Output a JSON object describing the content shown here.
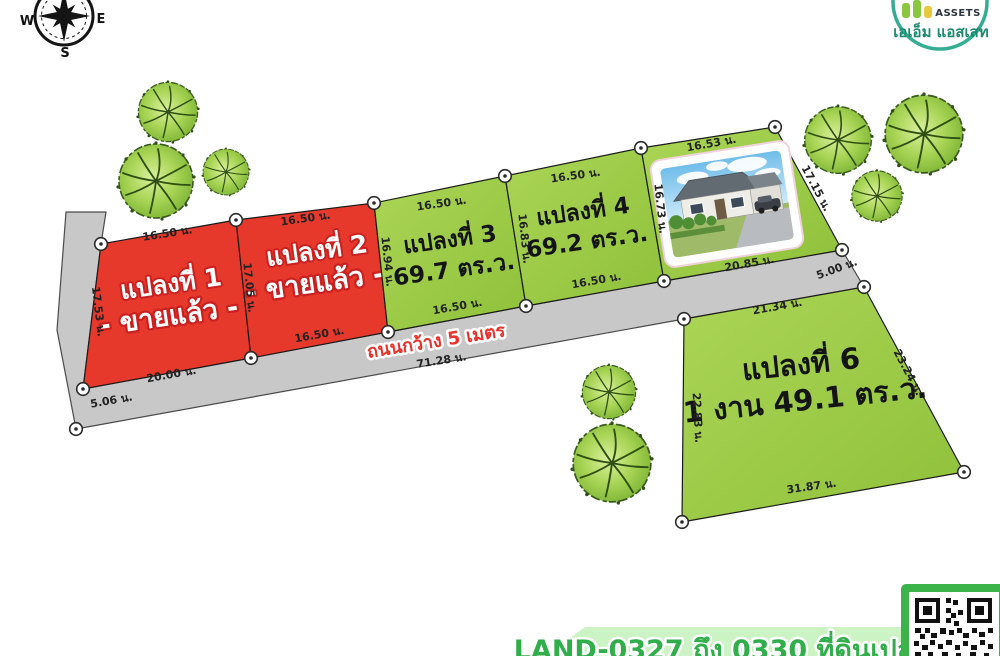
{
  "compass": {
    "west": "W",
    "east": "E",
    "south": "S"
  },
  "logo": {
    "name_en": "ASSETS",
    "name_th": "เอเอ็ม แอสเสท"
  },
  "plots": [
    {
      "label": "แปลงที่ 1",
      "status": "- ขายแล้ว -",
      "dim_top": "16.50 น.",
      "dim_left": "17.53 น.",
      "dim_bottom": "20.00 น.",
      "dim_right": "17.05 น."
    },
    {
      "label": "แปลงที่ 2",
      "status": "- ขายแล้ว -",
      "dim_top": "16.50 น.",
      "dim_bottom": "16.50 น.",
      "dim_right": "16.94 น."
    },
    {
      "label": "แปลงที่ 3",
      "area": "69.7 ตร.ว.",
      "dim_top": "16.50 น.",
      "dim_bottom": "16.50 น.",
      "dim_right": "16.83 น."
    },
    {
      "label": "แปลงที่ 4",
      "area": "69.2 ตร.ว.",
      "dim_top": "16.50 น.",
      "dim_bottom": "16.50 น.",
      "dim_right": "16.73 น."
    },
    {
      "dim_top": "16.53 น.",
      "dim_right": "17.15 น.",
      "dim_bottom": "20.85 น."
    },
    {
      "label": "แปลงที่ 6",
      "area": "1 งาน 49.1 ตร.ว.",
      "dim_top": "21.34 น.",
      "dim_left": "22.83 น.",
      "dim_right": "23.24 น.",
      "dim_bottom": "31.87 น."
    }
  ],
  "road": {
    "label": "ถนนกว้าง 5 เมตร",
    "dim_length": "71.28 น.",
    "dim_end_left": "5.06 น.",
    "dim_end_right": "5.00 น."
  },
  "banner": {
    "text": "LAND-0327 ถึง 0330 ที่ดินเปล่า 4 แปลง"
  },
  "colors": {
    "plot_sold": "#e6392c",
    "plot_available": "#9cc943",
    "road": "#c8c8c8",
    "banner_bg": "#cbf3c3",
    "banner_text": "#2fae4a",
    "logo_ring": "#35ad92"
  }
}
